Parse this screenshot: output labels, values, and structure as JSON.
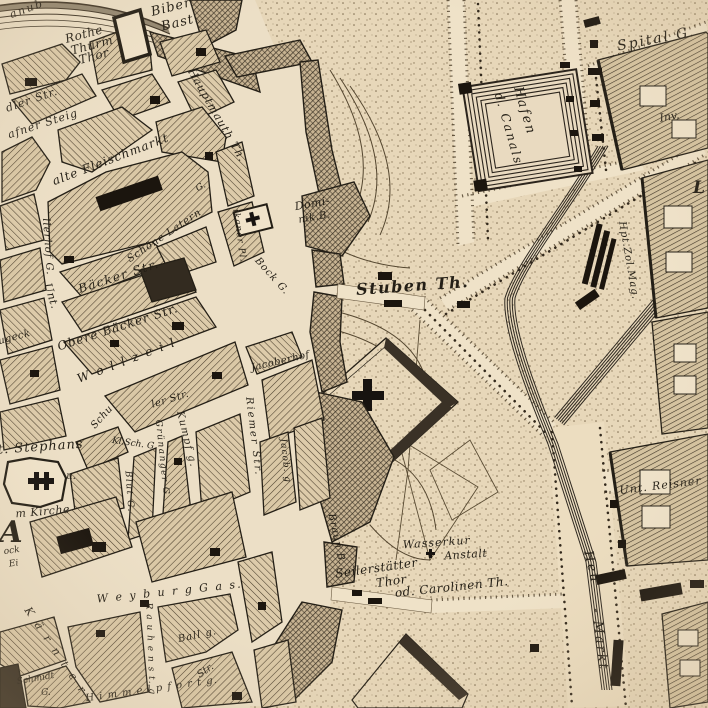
{
  "map": {
    "colors": {
      "paper": "#ecdfc6",
      "paper_light": "#f0e3ca",
      "ink": "#241f16",
      "hatch_line": "#4a3e2c",
      "dark_building": "#1b150e",
      "stipple_dot": "#7c6a4e"
    },
    "symbols": [
      {
        "name": "church-cross",
        "meaning": "church building marked with black cross"
      },
      {
        "name": "hatched-block",
        "meaning": "built-up city block"
      },
      {
        "name": "stippled-area",
        "meaning": "open glacis / esplanade ground"
      }
    ]
  },
  "labels": [
    {
      "name": "canal-edge-partial",
      "text": "anub",
      "x": 28,
      "y": 12,
      "rot": -20,
      "size": 11,
      "sp": 2
    },
    {
      "name": "biber-bastei-line1",
      "text": "Biber",
      "x": 172,
      "y": 11,
      "rot": -14,
      "size": 13,
      "sp": 1
    },
    {
      "name": "biber-bastei-line2",
      "text": "Bast.",
      "x": 181,
      "y": 26,
      "rot": -14,
      "size": 13,
      "sp": 1
    },
    {
      "name": "rothe-thurm-thor-line1",
      "text": "Rothe",
      "x": 85,
      "y": 38,
      "rot": -15,
      "size": 12,
      "sp": 0.5
    },
    {
      "name": "rothe-thurm-thor-line2",
      "text": "Thurm",
      "x": 93,
      "y": 49,
      "rot": -15,
      "size": 12,
      "sp": 0.5
    },
    {
      "name": "rothe-thurm-thor-line3",
      "text": "Thor",
      "x": 95,
      "y": 60,
      "rot": -15,
      "size": 12,
      "sp": 0.5
    },
    {
      "name": "spital-gasse",
      "text": "Spital G.",
      "x": 657,
      "y": 43,
      "rot": -11,
      "size": 14,
      "sp": 2
    },
    {
      "name": "hafen-canals-line1",
      "text": "Hafen",
      "x": 521,
      "y": 112,
      "rot": 74,
      "size": 13,
      "sp": 2
    },
    {
      "name": "hafen-canals-line2",
      "text": "d. Canals",
      "x": 505,
      "y": 130,
      "rot": 74,
      "size": 12,
      "sp": 2
    },
    {
      "name": "hauptmauth-thor",
      "text": "Hauptmauth Th.",
      "x": 214,
      "y": 117,
      "rot": 60,
      "size": 11,
      "sp": 1
    },
    {
      "name": "adler-strasse-partial",
      "text": "dler Str.",
      "x": 33,
      "y": 103,
      "rot": -19,
      "size": 11,
      "sp": 1
    },
    {
      "name": "hafner-steig-partial",
      "text": "afner Steig",
      "x": 44,
      "y": 127,
      "rot": -18,
      "size": 11,
      "sp": 1
    },
    {
      "name": "invalidenhaus-partial",
      "text": "Inv.",
      "x": 670,
      "y": 120,
      "rot": -10,
      "size": 11,
      "sp": 0
    },
    {
      "name": "l-partial",
      "text": "L",
      "x": 699,
      "y": 193,
      "rot": 0,
      "size": 17,
      "sp": 0
    },
    {
      "name": "alte-fleischmarkt",
      "text": "alte Fleischmarkt",
      "x": 112,
      "y": 163,
      "rot": -21,
      "size": 12,
      "sp": 1
    },
    {
      "name": "koellnerhof-gasse-partial",
      "text": "llerhof G.",
      "x": 45,
      "y": 247,
      "rot": 86,
      "size": 10,
      "sp": 1
    },
    {
      "name": "schoene-latern-gasse",
      "text": "Schöne Latern",
      "x": 166,
      "y": 238,
      "rot": -34,
      "size": 10,
      "sp": 1
    },
    {
      "name": "g-partial",
      "text": "G.",
      "x": 202,
      "y": 189,
      "rot": -30,
      "size": 9,
      "sp": 0
    },
    {
      "name": "haupt-zoll-magazin",
      "text": "Hpt.Zol.Mag.",
      "x": 626,
      "y": 261,
      "rot": 80,
      "size": 10,
      "sp": 1
    },
    {
      "name": "dominikaner-platz-partial",
      "text": "ikaner Pl.",
      "x": 237,
      "y": 236,
      "rot": 82,
      "size": 9,
      "sp": 1
    },
    {
      "name": "bock-gasse",
      "text": "Bock G.",
      "x": 270,
      "y": 278,
      "rot": 48,
      "size": 10,
      "sp": 1
    },
    {
      "name": "dominikaner-bastei-line1",
      "text": "Domi-",
      "x": 313,
      "y": 207,
      "rot": -10,
      "size": 11,
      "sp": 0.5
    },
    {
      "name": "dominikaner-bastei-line2",
      "text": "nik.B.",
      "x": 315,
      "y": 220,
      "rot": -10,
      "size": 10,
      "sp": 0.5
    },
    {
      "name": "stuben-thor",
      "text": "Stuben Th.",
      "x": 413,
      "y": 291,
      "rot": -4,
      "size": 16,
      "sp": 1.5
    },
    {
      "name": "untere-baecker-strasse-word1",
      "text": "Unt.",
      "x": 48,
      "y": 297,
      "rot": 72,
      "size": 11,
      "sp": 0.5
    },
    {
      "name": "untere-baecker-strasse-word2",
      "text": "Bäcker Str.",
      "x": 120,
      "y": 280,
      "rot": -18,
      "size": 12,
      "sp": 1.5
    },
    {
      "name": "obere-baecker-strasse",
      "text": "Obere Bäcker Str.",
      "x": 119,
      "y": 331,
      "rot": -18,
      "size": 12,
      "sp": 1
    },
    {
      "name": "wollzeile",
      "text": "W o l l z e i l",
      "x": 128,
      "y": 364,
      "rot": -21,
      "size": 12,
      "sp": 2
    },
    {
      "name": "lugeck-partial",
      "text": "ugeck",
      "x": 15,
      "y": 340,
      "rot": -15,
      "size": 10,
      "sp": 0.5
    },
    {
      "name": "schuler-strasse-word1",
      "text": "Schu",
      "x": 104,
      "y": 419,
      "rot": -48,
      "size": 10,
      "sp": 0.5
    },
    {
      "name": "schuler-strasse-word2",
      "text": "ler Str.",
      "x": 171,
      "y": 402,
      "rot": -17,
      "size": 10,
      "sp": 0.5
    },
    {
      "name": "kleine-schul-gasse",
      "text": "Kl.Sch. G.",
      "x": 134,
      "y": 446,
      "rot": 8,
      "size": 9,
      "sp": 0
    },
    {
      "name": "kumpf-gasse",
      "text": "Kumpf g.",
      "x": 184,
      "y": 440,
      "rot": 76,
      "size": 10,
      "sp": 1.5
    },
    {
      "name": "gruenanger-gasse",
      "text": "Grünanger G.",
      "x": 160,
      "y": 460,
      "rot": 84,
      "size": 9,
      "sp": 1.5
    },
    {
      "name": "blut-gasse",
      "text": "Blut G.",
      "x": 127,
      "y": 492,
      "rot": 86,
      "size": 9,
      "sp": 1.5
    },
    {
      "name": "riemer-strasse",
      "text": "Riemer Str.",
      "x": 251,
      "y": 437,
      "rot": 83,
      "size": 10,
      "sp": 2
    },
    {
      "name": "jacoberhof",
      "text": "Jacoberhof",
      "x": 281,
      "y": 364,
      "rot": -13,
      "size": 10,
      "sp": 0.5
    },
    {
      "name": "jacober-gasse",
      "text": "Jacob. g",
      "x": 283,
      "y": 461,
      "rot": 84,
      "size": 9,
      "sp": 1
    },
    {
      "name": "st-stephans",
      "text": "St. Stephans",
      "x": 36,
      "y": 451,
      "rot": -4,
      "size": 13,
      "sp": 1
    },
    {
      "name": "u-partial",
      "text": "u.",
      "x": 71,
      "y": 479,
      "rot": 0,
      "size": 10,
      "sp": 0
    },
    {
      "name": "dom-kirche-partial",
      "text": "m Kirche",
      "x": 43,
      "y": 515,
      "rot": -5,
      "size": 11,
      "sp": 0.5
    },
    {
      "name": "stadt-letter-a",
      "text": "A",
      "x": 11,
      "y": 542,
      "rot": 0,
      "size": 30,
      "sp": 0
    },
    {
      "name": "stock-im-eisen-partial1",
      "text": "ock",
      "x": 12,
      "y": 553,
      "rot": -8,
      "size": 9,
      "sp": 0
    },
    {
      "name": "stock-im-eisen-partial2",
      "text": "Ei",
      "x": 14,
      "y": 566,
      "rot": -8,
      "size": 9,
      "sp": 0
    },
    {
      "name": "weyburg-gasse",
      "text": "W e y b u r g  G a s.",
      "x": 170,
      "y": 595,
      "rot": -6,
      "size": 11,
      "sp": 2
    },
    {
      "name": "kaerntner-strasse",
      "text": "K ä r n t e r",
      "x": 53,
      "y": 653,
      "rot": 56,
      "size": 11,
      "sp": 3
    },
    {
      "name": "schmidt-gasse-line1",
      "text": "Schmidt",
      "x": 36,
      "y": 681,
      "rot": -10,
      "size": 9,
      "sp": 0
    },
    {
      "name": "schmidt-gasse-line2",
      "text": "G.",
      "x": 46,
      "y": 695,
      "rot": 0,
      "size": 9,
      "sp": 0
    },
    {
      "name": "rauhenstein-gasse",
      "text": "R a u h e n s t. g",
      "x": 148,
      "y": 649,
      "rot": 88,
      "size": 9,
      "sp": 1
    },
    {
      "name": "himmelpfort-gasse",
      "text": "H i m m e l p f o r t g.",
      "x": 152,
      "y": 692,
      "rot": -8,
      "size": 10,
      "sp": 1
    },
    {
      "name": "ball-gasse",
      "text": "Ball g.",
      "x": 198,
      "y": 638,
      "rot": -12,
      "size": 10,
      "sp": 1
    },
    {
      "name": "str-partial",
      "text": "Str.",
      "x": 207,
      "y": 673,
      "rot": -35,
      "size": 10,
      "sp": 0
    },
    {
      "name": "wasserkur-anstalt-line1",
      "text": "Wasserkur",
      "x": 437,
      "y": 546,
      "rot": -4,
      "size": 11,
      "sp": 1
    },
    {
      "name": "wasserkur-anstalt-line2",
      "text": "Anstalt",
      "x": 466,
      "y": 558,
      "rot": -4,
      "size": 11,
      "sp": 0.5
    },
    {
      "name": "seilerstaetter-thor-line1",
      "text": "Seilerstätter",
      "x": 377,
      "y": 572,
      "rot": -8,
      "size": 12,
      "sp": 0.5
    },
    {
      "name": "seilerstaetter-thor-line2",
      "text": "Thor",
      "x": 392,
      "y": 585,
      "rot": -8,
      "size": 12,
      "sp": 0.5
    },
    {
      "name": "seilerstaetter-thor-line3",
      "text": "od. Carolinen Th.",
      "x": 452,
      "y": 591,
      "rot": -6,
      "size": 12,
      "sp": 0.5
    },
    {
      "name": "braun-bastei",
      "text": "Braun B.",
      "x": 334,
      "y": 540,
      "rot": 78,
      "size": 10,
      "sp": 1
    },
    {
      "name": "heu-markt-word1",
      "text": "Heu",
      "x": 588,
      "y": 568,
      "rot": 76,
      "size": 13,
      "sp": 2
    },
    {
      "name": "heu-markt-word2",
      "text": "- Markt",
      "x": 596,
      "y": 640,
      "rot": 83,
      "size": 13,
      "sp": 2
    },
    {
      "name": "untere-reisner-strasse",
      "text": "Unt. Reisner",
      "x": 661,
      "y": 489,
      "rot": -7,
      "size": 11,
      "sp": 1
    }
  ]
}
